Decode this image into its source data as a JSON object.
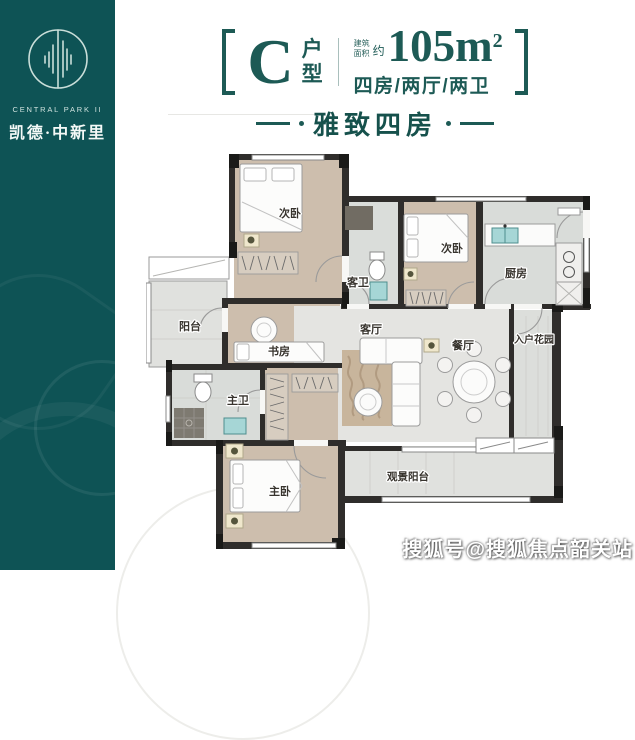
{
  "brand": {
    "icon": "split-circle-bars-logo",
    "name_en": "CENTRAL PARK II",
    "name_cn": "凯德·中新里"
  },
  "header": {
    "unit_letter": "C",
    "unit_label_top": "户",
    "unit_label_bottom": "型",
    "area_prefix_top": "建筑",
    "area_prefix_bottom": "面积",
    "area_approx": "约",
    "area_value": "105m",
    "area_unit_sup": "2",
    "layout_spec": "四房/两厅/两卫",
    "tagline": "雅致四房"
  },
  "plan": {
    "rooms": [
      {
        "id": "bedroom-left",
        "label": "次卧"
      },
      {
        "id": "bedroom-right",
        "label": "次卧"
      },
      {
        "id": "kitchen",
        "label": "厨房"
      },
      {
        "id": "guest-bath",
        "label": "客卫"
      },
      {
        "id": "balcony-left",
        "label": "阳台"
      },
      {
        "id": "study",
        "label": "书房"
      },
      {
        "id": "living-room",
        "label": "客厅"
      },
      {
        "id": "dining-room",
        "label": "餐厅"
      },
      {
        "id": "entry-garden",
        "label": "入户花园"
      },
      {
        "id": "master-bath",
        "label": "主卫"
      },
      {
        "id": "master-bedroom",
        "label": "主卧"
      },
      {
        "id": "view-balcony",
        "label": "观景阳台"
      }
    ]
  },
  "watermark": {
    "text": "搜狐号@搜狐焦点韶关站"
  },
  "colors": {
    "teal_band": "#0e5355",
    "heading": "#1d5a55",
    "wall": "#2f2d2b",
    "wood_floor": "#cdbead",
    "tile_floor": "#d9dcd9",
    "gray_floor": "#e4e4e1",
    "fixture_teal": "#a6d6d6"
  }
}
